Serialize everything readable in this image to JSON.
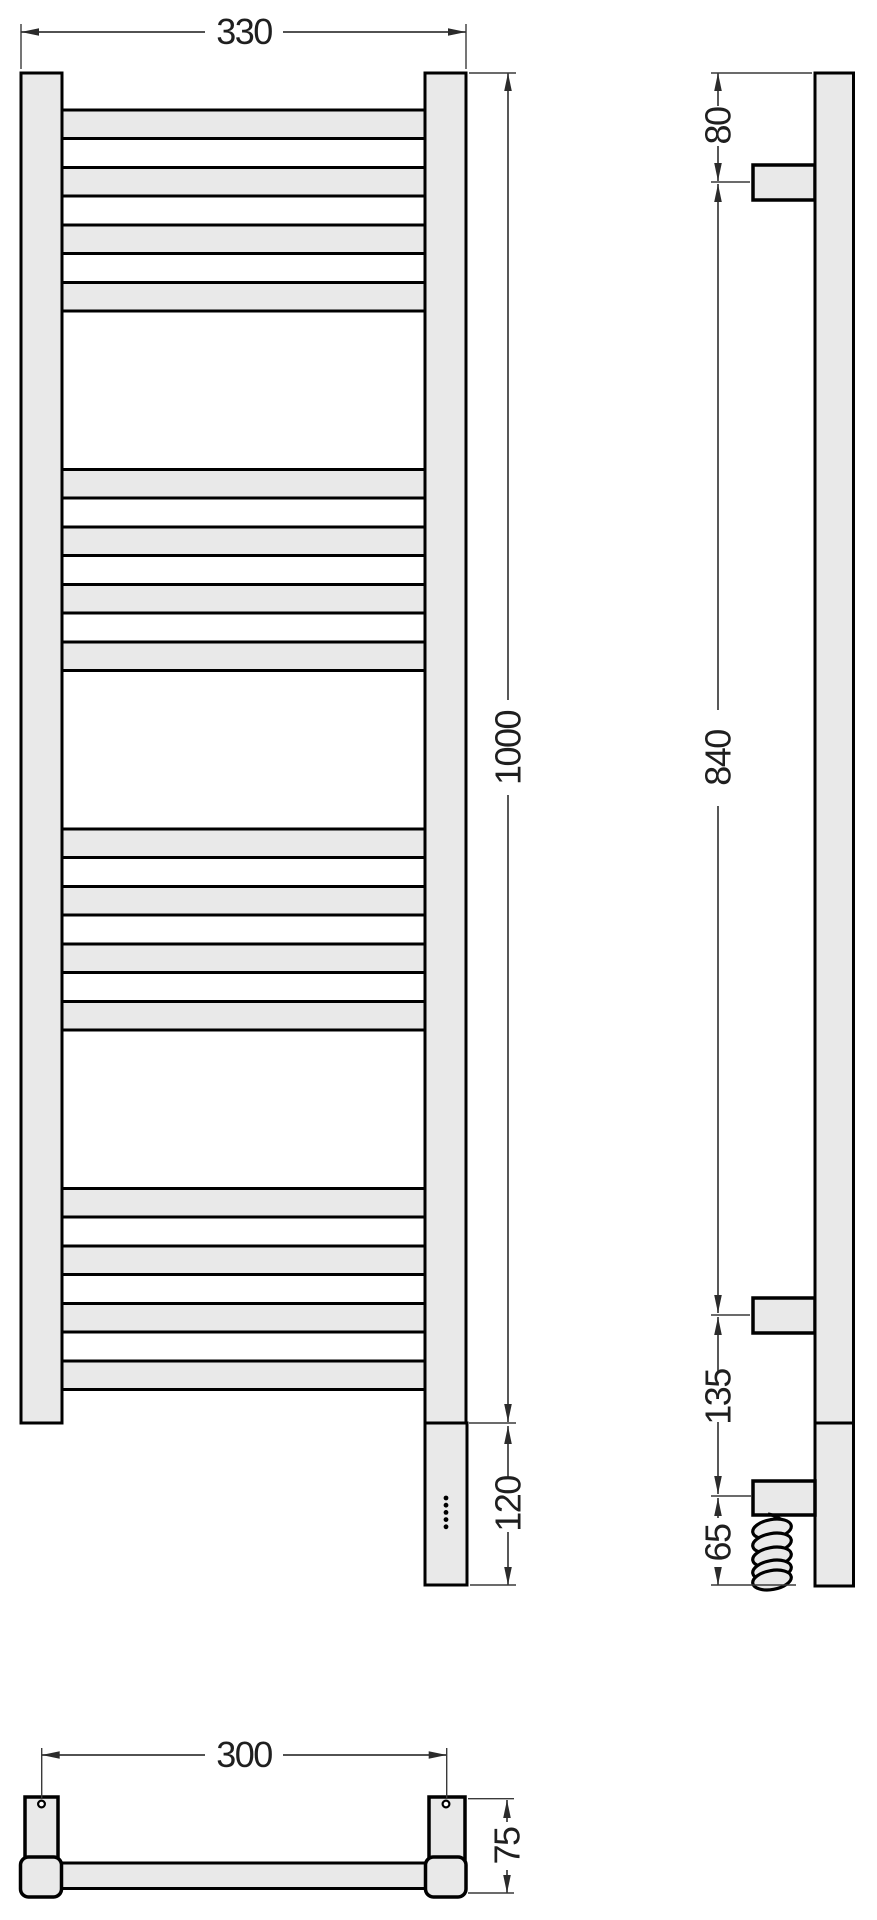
{
  "drawing": {
    "type": "technical-dimension-drawing",
    "subject": "ladder towel rail radiator - front, side and top orthographic views",
    "unit": "mm",
    "colors": {
      "background": "#ffffff",
      "part_fill": "#e9e9e9",
      "part_outline": "#000000",
      "dimension_line": "#3a3a3a",
      "text": "#1f1f1f"
    },
    "structure": {
      "rung_count": 16,
      "rung_groups": 4,
      "rungs_per_group": 4,
      "heater_dot_count": 5
    },
    "dims": {
      "front_width": {
        "value": "330"
      },
      "front_height": {
        "value": "1000"
      },
      "front_heater_height": {
        "value": "120"
      },
      "side_top_offset": {
        "value": "80"
      },
      "side_bracket_span": {
        "value": "840"
      },
      "side_lower_offset": {
        "value": "135"
      },
      "side_cable_drop": {
        "value": "65"
      },
      "top_mount_spacing": {
        "value": "300"
      },
      "top_depth": {
        "value": "75"
      }
    }
  }
}
